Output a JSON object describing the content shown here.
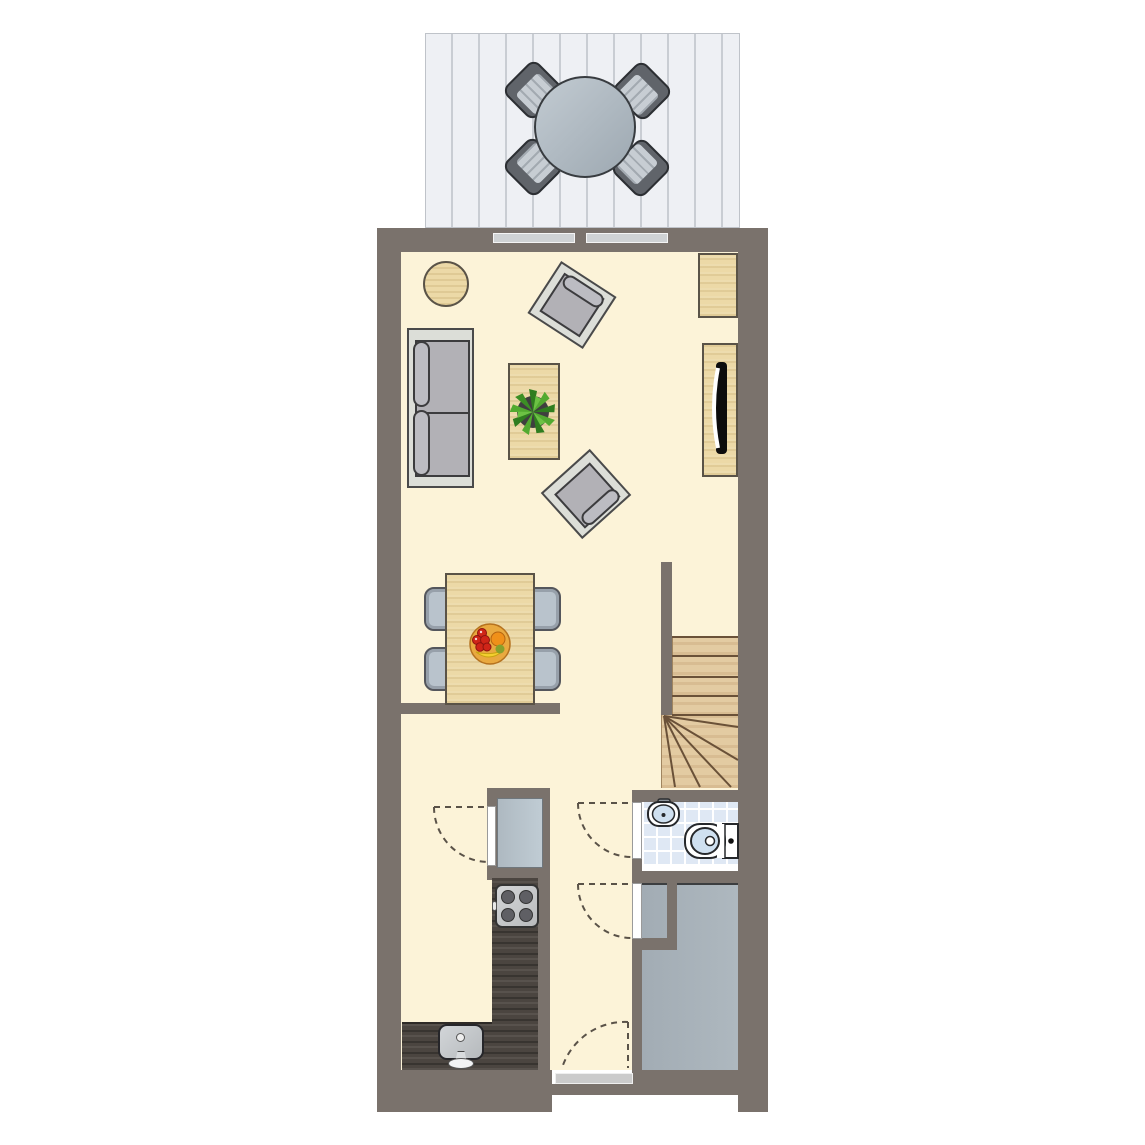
{
  "title": "single-storey floor plan, ground floor of a terraced house",
  "visible_text": [],
  "palette": {
    "wall": "#7a726c",
    "interior_floor": "#fcf3d8",
    "terrace_deck": "#eef0f4",
    "deck_board_line": "#c9cdd3",
    "bathroom_tile": "#dfe8f4",
    "tile_grout": "#ffffff",
    "storage_floor": "#a9b3ba",
    "light_wood_furniture": "#ecd9a7",
    "stair_wood": "#e3cba2",
    "kitchen_counter_dark_wood": "#4b4540",
    "upholstery_gray": "#b2b1b6",
    "upholstery_frame": "#dcded8",
    "dining_chair_blue_gray": "#b9c3cc",
    "appliance_blue_gray": "#b8c4cc",
    "sanitary_white": "#ffffff",
    "sanitary_basin_blue": "#cfe0f0",
    "threshold_gray": "#cbcbcb",
    "window_gray": "#cfd2d4",
    "door_swing_dash": "#5a5248",
    "plant_green_dark": "#2f7d1f",
    "plant_green_light": "#52aa30",
    "fruit_bowl_orange": "#e9a93f",
    "fruit_red": "#cf2518",
    "fruit_orange": "#f09019",
    "fruit_yellow": "#f3d02f"
  },
  "spaces": {
    "terrace": {
      "furniture": {
        "round_table": 1,
        "striped_chairs": 4
      },
      "floor": "vertical deck boards"
    },
    "living_room": {
      "furniture": [
        "round-side-table",
        "sofa-2-seat",
        "armchair-rotated-right",
        "armchair-rotated-left",
        "coffee-table-with-plant",
        "corner-cabinet",
        "tv-sideboard-with-tv"
      ],
      "windows_to_terrace": 2
    },
    "dining_area": {
      "furniture": [
        "dining-table",
        "chairs x4",
        "fruit-bowl"
      ]
    },
    "kitchen": {
      "fixtures": [
        "closet-with-appliance",
        "stove-4-burners",
        "l-shaped-dark-counter",
        "sink-with-faucet"
      ]
    },
    "hallway": {
      "doors": [
        "front-entry-door-with-threshold",
        "bathroom-door",
        "storage-room-door",
        "kitchen-closet-door"
      ]
    },
    "bathroom": {
      "fixtures": [
        "washbasin-with-tap",
        "toilet-with-cistern"
      ],
      "floor": "tiled"
    },
    "storage_room": {
      "floor": "plain gray",
      "partition_stub": true
    },
    "stairs": {
      "type": "winder",
      "straight_tread_lines": 4,
      "winder_fan_lines": 5
    }
  }
}
